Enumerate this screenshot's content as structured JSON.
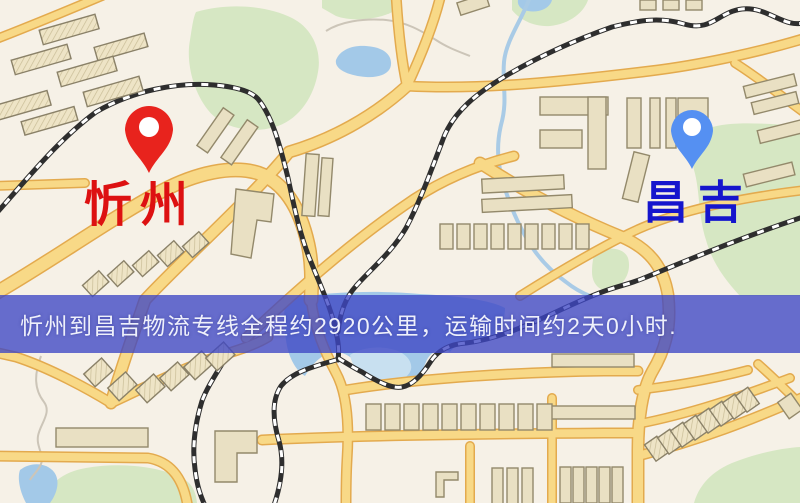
{
  "map": {
    "markers": {
      "origin": {
        "label": "忻州",
        "label_color": "#dd1111",
        "pin_color": "#e8231d"
      },
      "destination": {
        "label": "昌吉",
        "label_color": "#1515cd",
        "pin_color": "#5590f2"
      }
    },
    "banner": {
      "text": "忻州到昌吉物流专线全程约2920公里，运输时间约2天0小时.",
      "distance_text": "约2920公里",
      "duration_text": "约2天0小时",
      "background": "#3e46c4",
      "text_color": "#eef0fb"
    },
    "palette": {
      "background": "#f6f1e7",
      "road_fill": "#f8d987",
      "road_casing": "#e3aa4e",
      "water": "#a3c9e8",
      "park": "#d6e7c3",
      "building": "#e9e0c3",
      "railway": "#2e2e2e"
    }
  }
}
